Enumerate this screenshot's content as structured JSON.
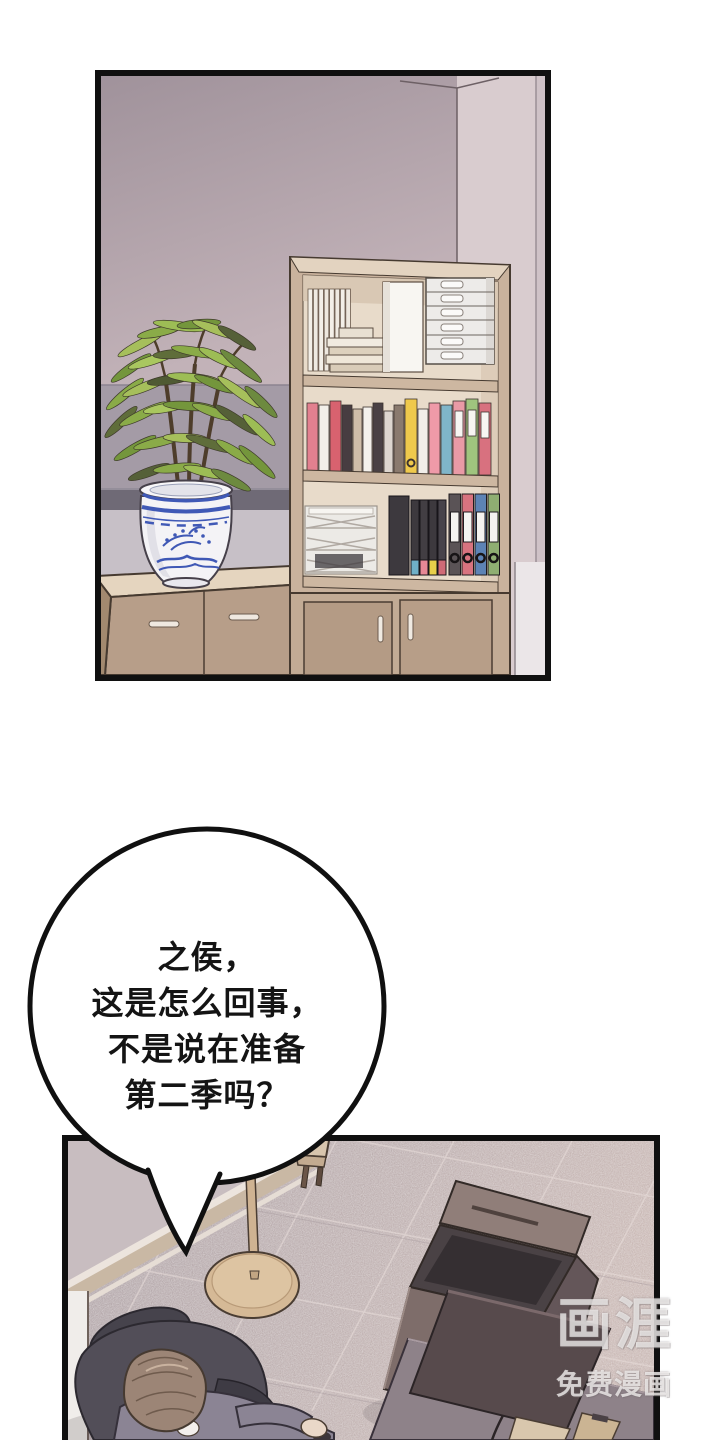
{
  "speech_bubble": {
    "lines": [
      "之侯，",
      "这是怎么回事，",
      "不是说在准备",
      "第二季吗？"
    ]
  },
  "watermark": {
    "logo": "画涯",
    "subtitle": "免费漫画"
  },
  "palette": {
    "page_background": "#ffffff",
    "panel_border": "#101010",
    "bubble_fill": "#ffffff",
    "bubble_outline": "#101010",
    "wall_mauve": "#c2b2b8",
    "wall_light": "#d9cccf",
    "trim_gray": "#6f6a76",
    "shelf_tan": "#c9b29d",
    "cabinet_tan": "#b79e89",
    "pot_white": "#f4f3f6",
    "pot_blue": "#3f58b5",
    "plant_green": "#8aab48",
    "carpet": "#bfb1b1",
    "copier_brown": "#7e6d6a",
    "desk_gray": "#8e8289",
    "monitor_dark": "#574a4c",
    "chair_dark": "#524e58",
    "shirt_gray": "#8b8494",
    "hair_brown": "#9c8576",
    "lamp_tan": "#d5b996"
  }
}
